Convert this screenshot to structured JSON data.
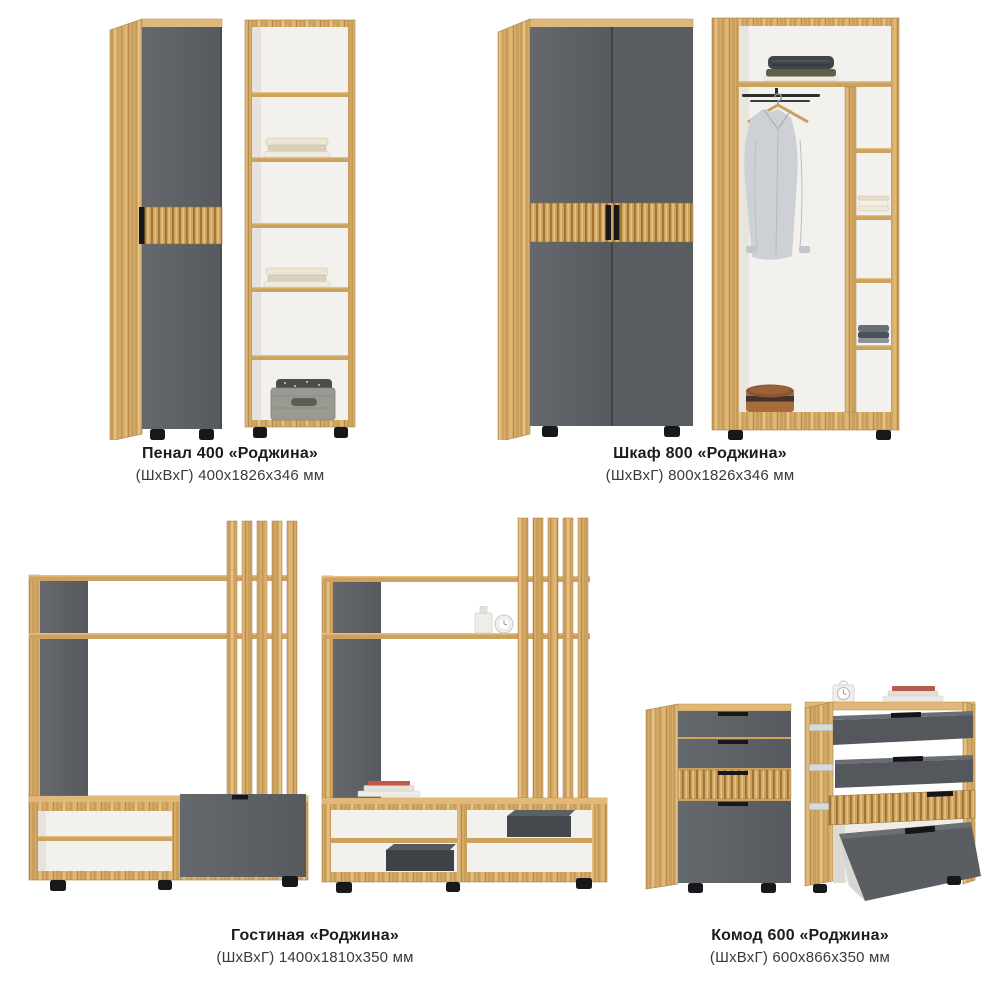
{
  "page": {
    "background": "#ffffff"
  },
  "colors": {
    "wood": "#d5ab6a",
    "wood_light": "#e0b97a",
    "wood_dark": "#a87d42",
    "fluted_wood": "#cfa25c",
    "gray_front": "#5d6165",
    "gray_front_dark": "#53575b",
    "interior_white": "#f3f1ed",
    "feet_black": "#17181a",
    "text_primary": "#1c1c1c",
    "text_secondary": "#3a3a3a"
  },
  "products": [
    {
      "name": "Пенал 400 «Роджина»",
      "dims": "(ШхВхГ) 400х1826х346 мм"
    },
    {
      "name": "Шкаф 800 «Роджина»",
      "dims": "(ШхВхГ) 800х1826х346 мм"
    },
    {
      "name": "Гостиная «Роджина»",
      "dims": "(ШхВхГ) 1400х1810х350 мм"
    },
    {
      "name": "Комод 600 «Роджина»",
      "dims": "(ШхВхГ) 600х866х350 мм"
    }
  ]
}
